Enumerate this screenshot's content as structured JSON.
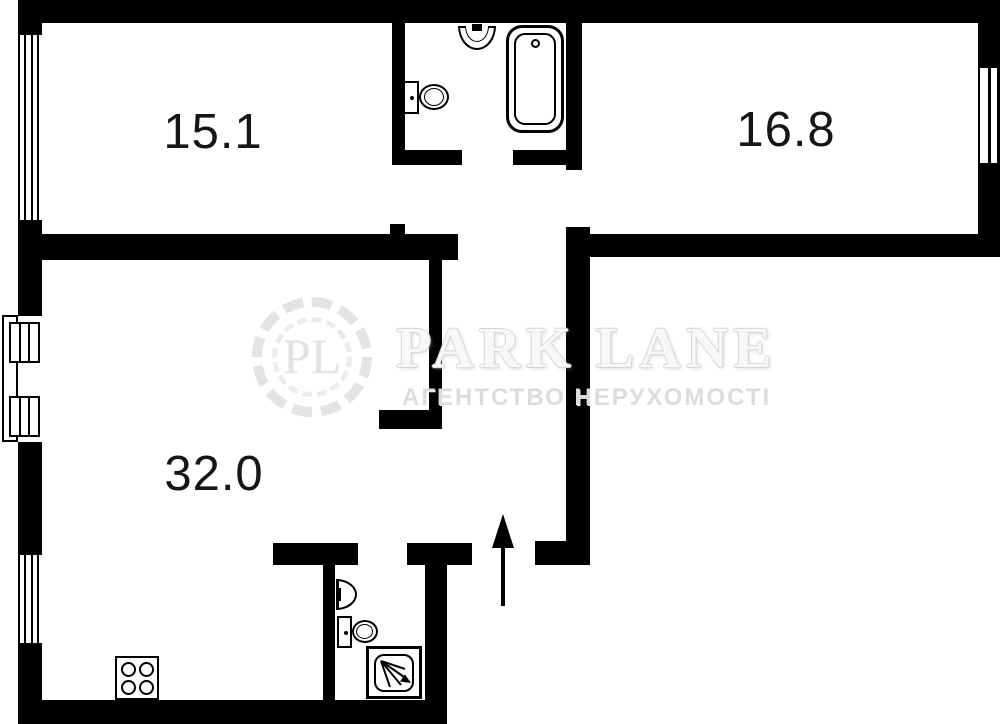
{
  "plan": {
    "rooms": [
      {
        "name": "room-top-left",
        "area": "15.1"
      },
      {
        "name": "room-top-right",
        "area": "16.8"
      },
      {
        "name": "room-bottom-left",
        "area": "32.0"
      }
    ]
  },
  "watermark": {
    "monogram": "PL",
    "brand": "PARK LANE",
    "tagline": "АГЕНТСТВО НЕРУХОМОСТІ"
  },
  "icons": {
    "bathroom_top": [
      "sink-icon",
      "toilet-icon",
      "bathtub-icon"
    ],
    "bathroom_bottom": [
      "sink-icon",
      "toilet-icon",
      "shower-icon"
    ],
    "kitchen": [
      "stove-icon"
    ],
    "entrance": [
      "entrance-arrow-icon"
    ],
    "openings": [
      "window",
      "window",
      "window",
      "balcony-door"
    ]
  },
  "colors": {
    "wall": "#000000",
    "background": "#ffffff",
    "label_text": "#161616",
    "watermark_text": "#e0e0e0"
  }
}
